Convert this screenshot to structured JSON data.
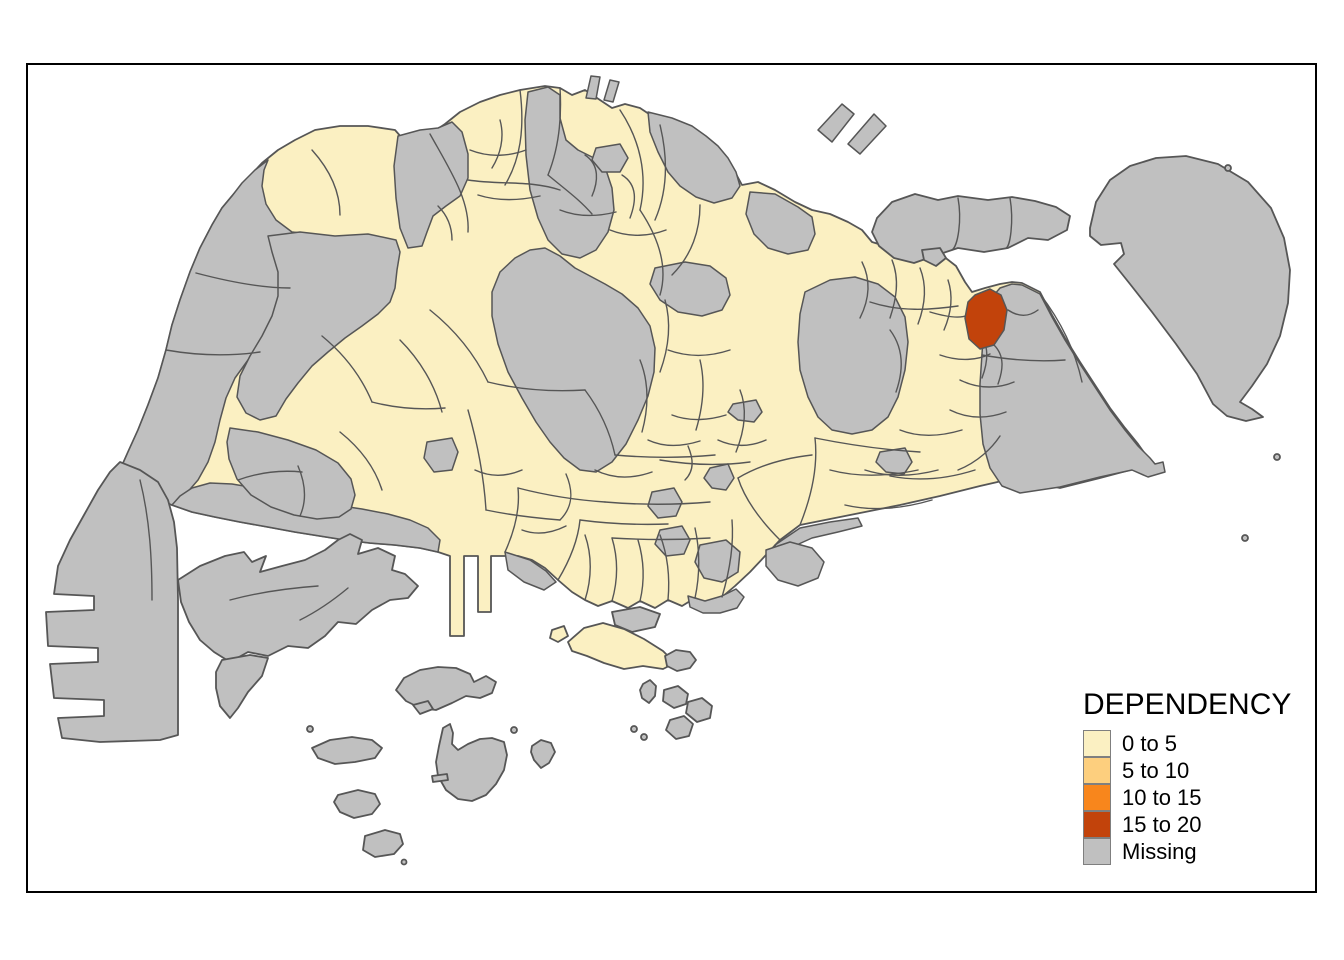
{
  "figure": {
    "background_color": "#FFFFFF",
    "frame_color": "#000000"
  },
  "legend": {
    "title": "DEPENDENCY",
    "items": [
      {
        "label": "0 to 5",
        "color": "#FBF0C2"
      },
      {
        "label": "5 to 10",
        "color": "#FDCF7E"
      },
      {
        "label": "10 to 15",
        "color": "#F8861C"
      },
      {
        "label": "15 to 20",
        "color": "#C2430B"
      },
      {
        "label": "Missing",
        "color": "#C0C0C0"
      }
    ],
    "swatch_border_color": "#7F7F7F"
  },
  "map": {
    "type": "choropleth",
    "location": "Singapore planning subzones",
    "boundary_color": "#565656",
    "class_colors": {
      "0 to 5": "#FBF0C2",
      "5 to 10": "#FDCF7E",
      "10 to 15": "#F8861C",
      "15 to 20": "#C2430B",
      "Missing": "#C0C0C0"
    },
    "highlighted_region": {
      "class": "15 to 20",
      "position": "northeast coastal subzone"
    }
  }
}
